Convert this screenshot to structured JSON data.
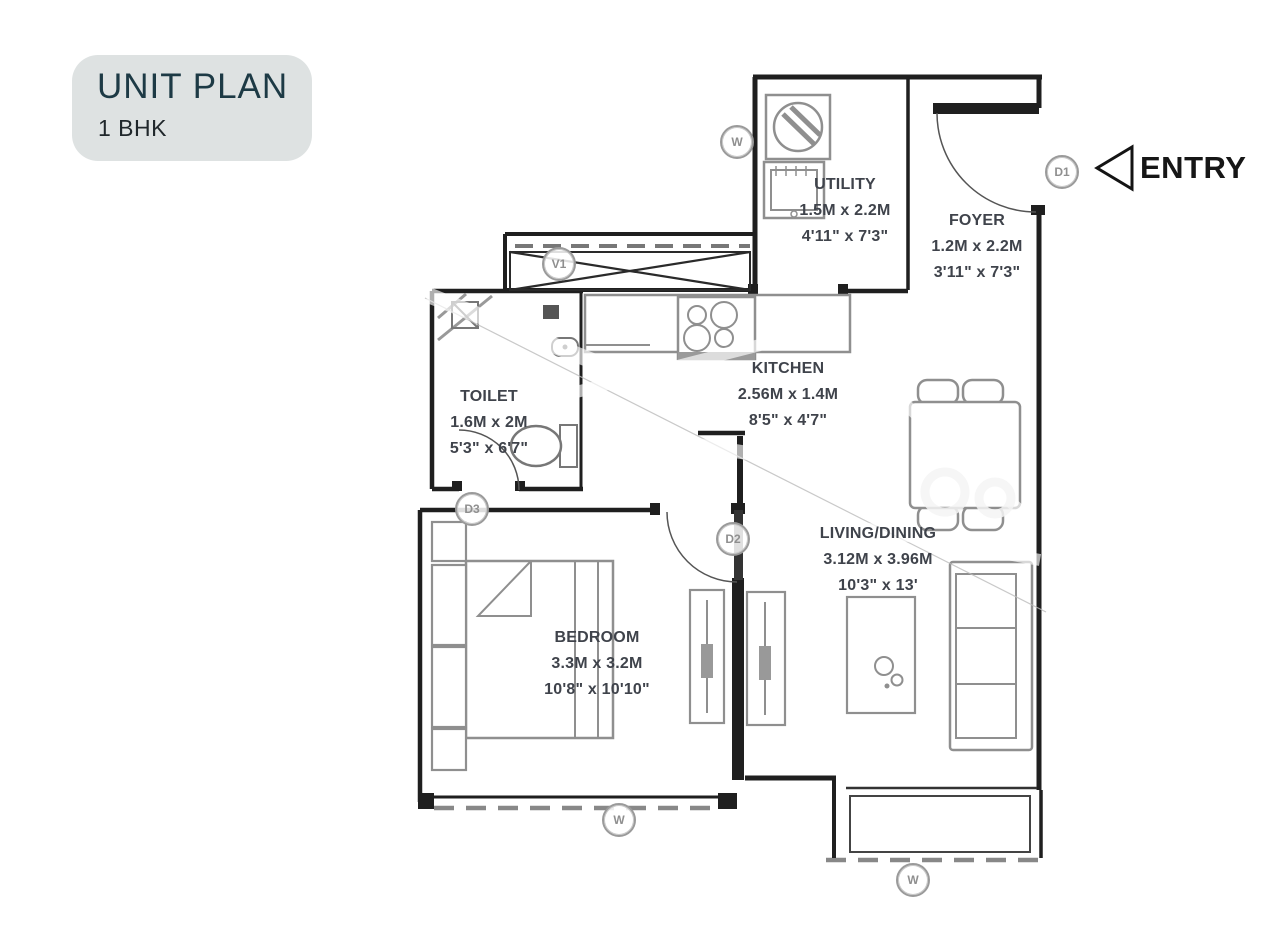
{
  "title_card": {
    "title": "UNIT PLAN",
    "subtitle": "1 BHK"
  },
  "entry": {
    "label": "ENTRY"
  },
  "rooms": {
    "utility": {
      "name": "UTILITY",
      "metric": "1.5M x 2.2M",
      "imperial": "4'11\" x 7'3\""
    },
    "foyer": {
      "name": "FOYER",
      "metric": "1.2M x 2.2M",
      "imperial": "3'11\" x 7'3\""
    },
    "kitchen": {
      "name": "KITCHEN",
      "metric": "2.56M x 1.4M",
      "imperial": "8'5\" x 4'7\""
    },
    "toilet": {
      "name": "TOILET",
      "metric": "1.6M x 2M",
      "imperial": "5'3\" x 6'7\""
    },
    "living_dining": {
      "name": "LIVING/DINING",
      "metric": "3.12M x 3.96M",
      "imperial": "10'3\" x 13'"
    },
    "bedroom": {
      "name": "BEDROOM",
      "metric": "3.3M x 3.2M",
      "imperial": "10'8\" x 10'10\""
    }
  },
  "markers": {
    "door1": "D1",
    "door2": "D2",
    "door3": "D3",
    "vent1": "V1",
    "window": "W"
  },
  "colors": {
    "wall": "#1f1f1f",
    "furniture": "#8f8f8f",
    "label_text": "#3f434b",
    "title_text": "#1d3a45",
    "card_bg": "#dee2e2",
    "marker": "#9a9a9a"
  }
}
